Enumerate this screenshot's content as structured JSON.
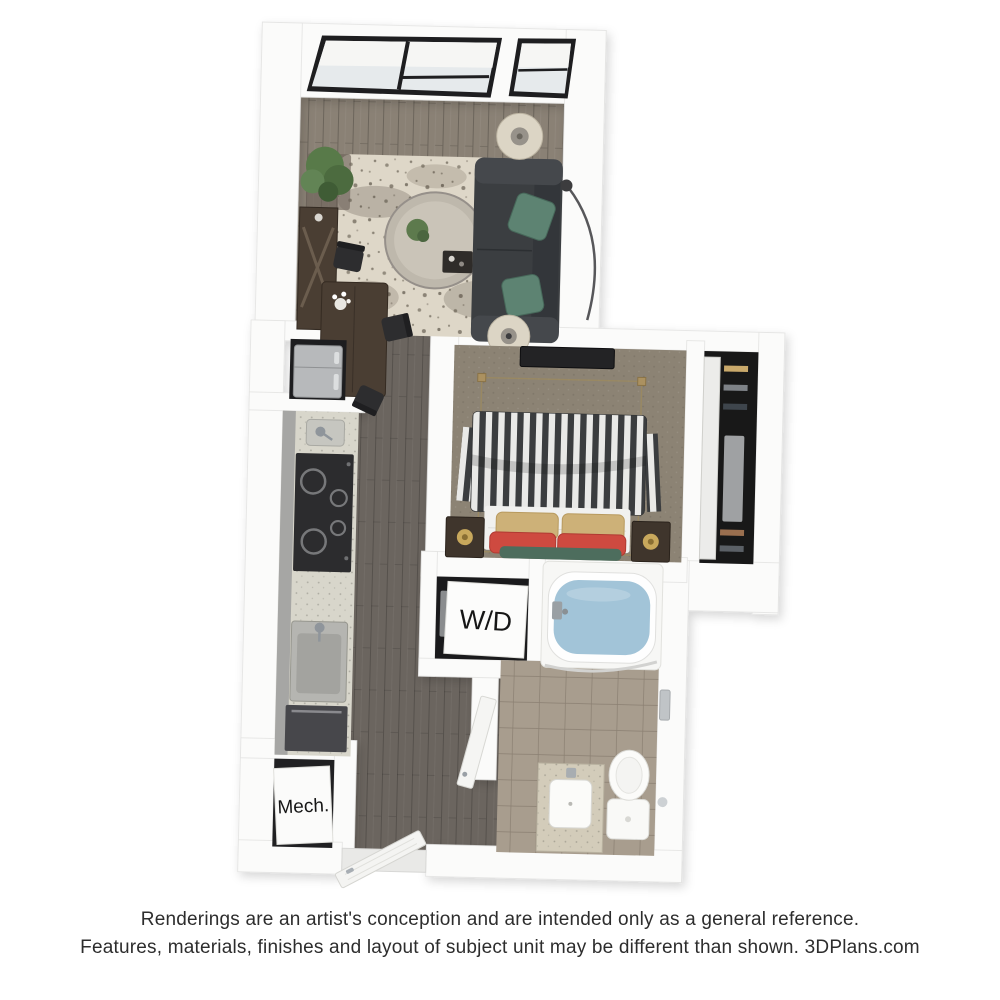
{
  "floorplan": {
    "labels": {
      "washer_dryer": "W/D",
      "mechanical": "Mech."
    },
    "colors": {
      "wall": "#fbfbfa",
      "living_floor": "#8a8175",
      "hall_floor": "#6b655f",
      "bedroom_carpet": "#8c8374",
      "bath_tile": "#a89d8e",
      "rug": "#ded7c8",
      "sofa": "#3b3e41",
      "sofa_pillow_green": "#5d8372",
      "pillow_tan": "#cdb178",
      "pillow_red": "#ce4a40",
      "pillow_dark_green": "#4d6d5d",
      "stripe_dark": "#3b3d3f",
      "stripe_light": "#e9e9e7",
      "water": "#a2c4d8",
      "wood_dark": "#4a3e33",
      "tv_black": "#232325",
      "stainless": "#b7b9bb"
    }
  },
  "footer": {
    "line1": "Renderings are an artist's conception and are intended only as a general reference.",
    "line2": "Features, materials, finishes and layout of subject unit may be different than shown. 3DPlans.com"
  }
}
